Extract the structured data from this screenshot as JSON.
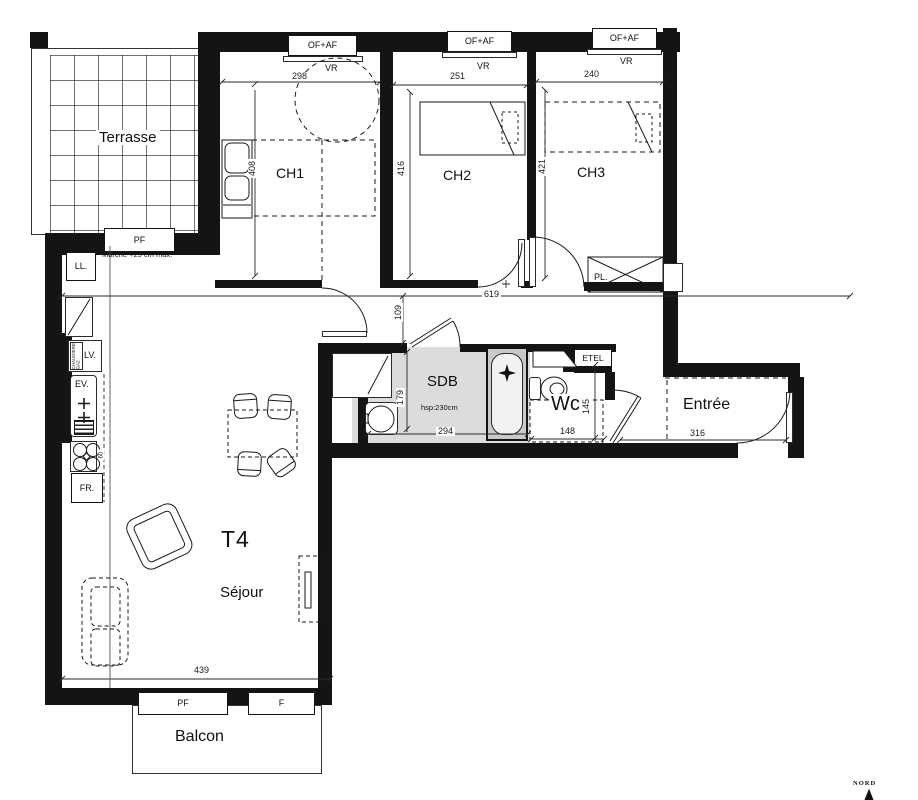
{
  "plan": {
    "rooms": {
      "terrasse": "Terrasse",
      "ch1": "CH1",
      "ch2": "CH2",
      "ch3": "CH3",
      "sdb": "SDB",
      "wc": "Wc",
      "entree": "Entrée",
      "t4": "T4",
      "sejour": "Séjour",
      "balcon": "Balcon"
    },
    "openings": {
      "of_af": "OF+AF",
      "vr": "VR",
      "pf": "PF",
      "f": "F"
    },
    "storage": {
      "pl": "PL.",
      "etel": "ETEL"
    },
    "kitchen": {
      "ll": "LL.",
      "lv": "LV.",
      "ev": "EV.",
      "fr": "FR.",
      "boiler": "CHAUDIERE GAZ"
    },
    "dims": {
      "ch1_w": "298",
      "ch2_w": "251",
      "ch3_w": "240",
      "ch1_d": "408",
      "ch2_d": "416",
      "ch3_d": "421",
      "hall_w": "619",
      "hall_d": "109",
      "sdb_d": "179",
      "sdb_w": "294",
      "wc_w": "148",
      "wc_d": "145",
      "entree_w": "316",
      "sejour_w": "439",
      "worktop": "60"
    },
    "notes": {
      "step": "Marche +25 cm max.",
      "ceiling_height": "hsp:230cm",
      "north": "NORD"
    },
    "colors": {
      "wall": "#141414",
      "sdb_fill": "#dcdcdc"
    }
  }
}
